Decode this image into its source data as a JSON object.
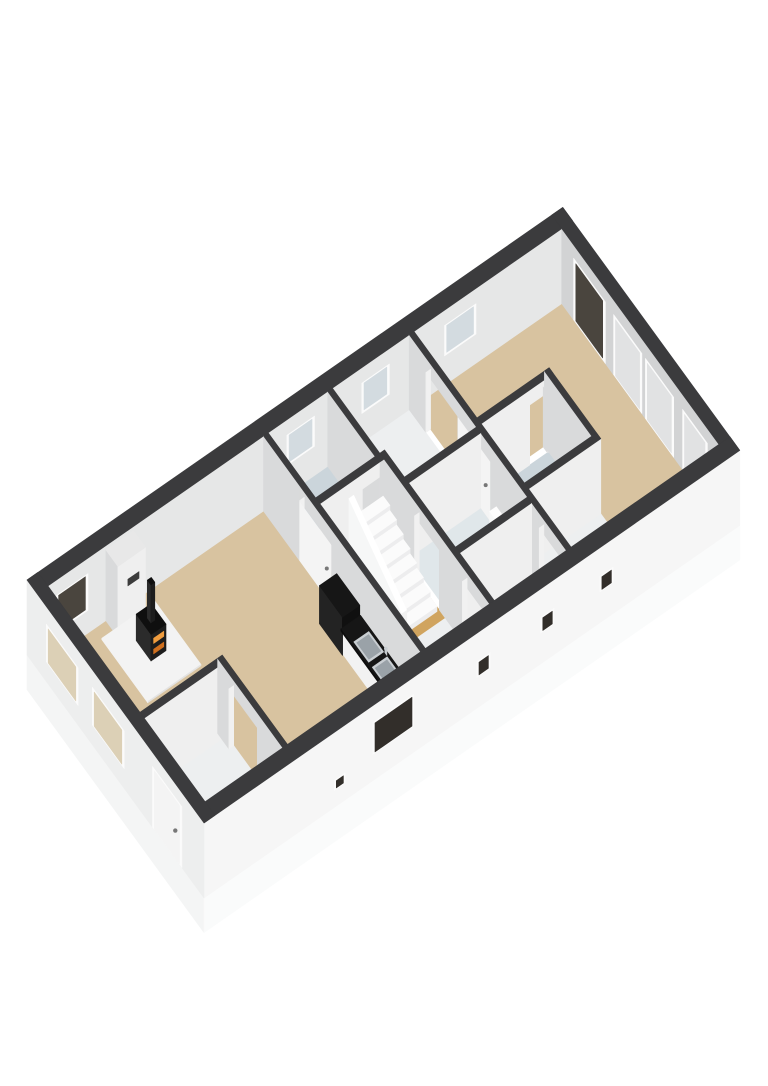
{
  "scene": {
    "kind": "3d-axonometric-floorplan",
    "background": "#ffffff",
    "storey": "single floor cutaway, no text labels"
  },
  "colors": {
    "background": "#ffffff",
    "wall_top": "#3b3b3d",
    "wall_nw": "#e6e7e7",
    "wall_ne": "#d2d3d4",
    "wall_se_face": "#efefef",
    "wall_sw_face": "#d9dadb",
    "wall_cap": "#f1f1f1",
    "ext_se": "#f6f6f6",
    "ext_sw": "#edeeee",
    "slab_sw": "#f4f5f5",
    "slab_se": "#fafbfb",
    "floor_living": "#d8c3a0",
    "floor_hall": "#d0a45f",
    "floor_bath": "#cbd5db",
    "floor_wc": "#e0e7ea",
    "floor_corridor": "#edeff0",
    "frame": "#fbfbfb",
    "glass_dark": "#4a453e",
    "glass_se": "#322e2a",
    "glass_light": "#d3dbe0",
    "glass_warm": "#dcd0b6",
    "panel": "#e1e2e3",
    "door_leaf": "#f4f4f4",
    "handle": "#777777",
    "stairs_tread": "#fbfbfb",
    "stairs_riser": "#ededee",
    "balustrade_face": "#f6f7f7",
    "balustrade_top": "#ffffff",
    "hearth": "#f3f3f3",
    "hearth_edge": "#e3e3e3",
    "breast_top": "#e8e8e8",
    "flue": "#3c3c3c",
    "stove_front": "#1d1d1d",
    "stove_side": "#2b2b2b",
    "stove_top": "#0f0f0f",
    "glow1": "#ef9c3e",
    "glow2": "#cf6f1e",
    "counter_top": "#161616",
    "counter_edge": "#0d0d0d",
    "counter_dark2": "#232323",
    "counter_dark3": "#101010",
    "cabinet": "#f2f2f2",
    "sink_rim": "#c9ced2",
    "sink_inner": "#9aa2a8",
    "fixture": "#f7f8f8",
    "fixture_top": "#fdfdfd",
    "fixture_shade": "#e8ebec"
  },
  "rooms": [
    {
      "id": "living",
      "name": "living-room",
      "floor": "floor_living"
    },
    {
      "id": "entrance",
      "name": "entrance-hall",
      "floor": "floor_corridor"
    },
    {
      "id": "bath1",
      "name": "bathroom",
      "floor": "floor_bath"
    },
    {
      "id": "hall",
      "name": "stair-hallway",
      "floor": "floor_hall"
    },
    {
      "id": "corrS",
      "name": "south-corridor",
      "floor": "floor_corridor"
    },
    {
      "id": "landing",
      "name": "north-landing",
      "floor": "floor_corridor"
    },
    {
      "id": "wc",
      "name": "toilet-room",
      "floor": "floor_wc"
    },
    {
      "id": "corrSE",
      "name": "south-corridor-2",
      "floor": "floor_corridor"
    },
    {
      "id": "bedroom",
      "name": "bedroom",
      "floor": "floor_living"
    },
    {
      "id": "bath2",
      "name": "bathroom-2",
      "floor": "floor_bath"
    },
    {
      "id": "storage",
      "name": "storage-corridor",
      "floor": "floor_corridor"
    }
  ],
  "openings": {
    "windows": [
      {
        "id": "winWestDark",
        "wall": "northwest",
        "glass": "glass_dark"
      },
      {
        "id": "winBath",
        "wall": "northwest",
        "glass": "glass_light"
      },
      {
        "id": "winLanding",
        "wall": "northwest",
        "glass": "glass_light"
      },
      {
        "id": "winBedroom",
        "wall": "northwest",
        "glass": "glass_light"
      },
      {
        "id": "winVentSE",
        "wall": "southeast",
        "glass": "glass_se"
      },
      {
        "id": "winKitchen",
        "wall": "southeast",
        "glass": "glass_se"
      },
      {
        "id": "winSE1",
        "wall": "southeast",
        "glass": "glass_se"
      },
      {
        "id": "winSE2",
        "wall": "southeast",
        "glass": "glass_se"
      },
      {
        "id": "winSE3",
        "wall": "southeast",
        "glass": "glass_se"
      },
      {
        "id": "winSW1",
        "wall": "southwest",
        "glass": "glass_warm"
      },
      {
        "id": "winSW2",
        "wall": "southwest",
        "glass": "glass_warm"
      }
    ],
    "doors": [
      {
        "id": "frontDoor",
        "wall": "southwest",
        "leaf": "door_leaf"
      },
      {
        "id": "terraceDoor",
        "wall": "northeast",
        "leaf": "glass_dark"
      },
      {
        "id": "closetPanels",
        "wall": "northeast",
        "leaf": "panel"
      },
      {
        "id": "livingDoor",
        "wall": "w1",
        "leaf": "door_leaf"
      },
      {
        "id": "bedroomDoor",
        "wall": "w2",
        "leaf": "door_leaf"
      }
    ]
  },
  "furniture": [
    {
      "id": "chimneyBreast",
      "name": "chimney-breast"
    },
    {
      "id": "hearth",
      "name": "hearth-plate"
    },
    {
      "id": "stove",
      "name": "wood-stove"
    },
    {
      "id": "counter",
      "name": "kitchen-counter"
    },
    {
      "id": "sinks",
      "name": "kitchen-sinks"
    },
    {
      "id": "stairs",
      "name": "staircase"
    },
    {
      "id": "toilet",
      "name": "toilet"
    }
  ]
}
